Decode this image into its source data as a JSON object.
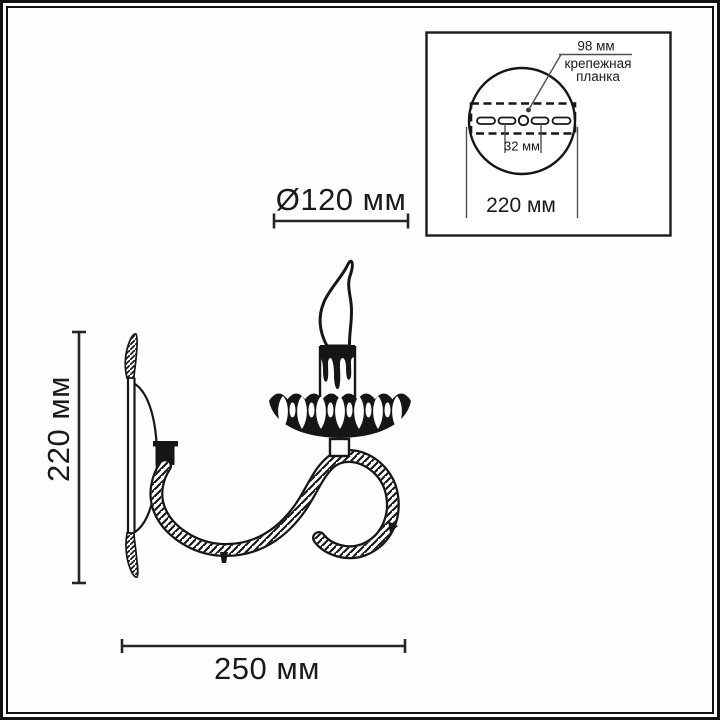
{
  "colors": {
    "ink": "#161616",
    "dimension_line": "#262626",
    "leader_line": "#4f4f4f",
    "background": "#ffffff"
  },
  "main_view": {
    "shade_diameter": "Ø120 мм",
    "height": "220 мм",
    "depth": "250 мм"
  },
  "mount_inset": {
    "bracket_width": "98 мм",
    "caption_line1": "крепежная",
    "caption_line2": "планка",
    "slot_spacing": "32 мм",
    "plate_diameter": "220 мм"
  }
}
